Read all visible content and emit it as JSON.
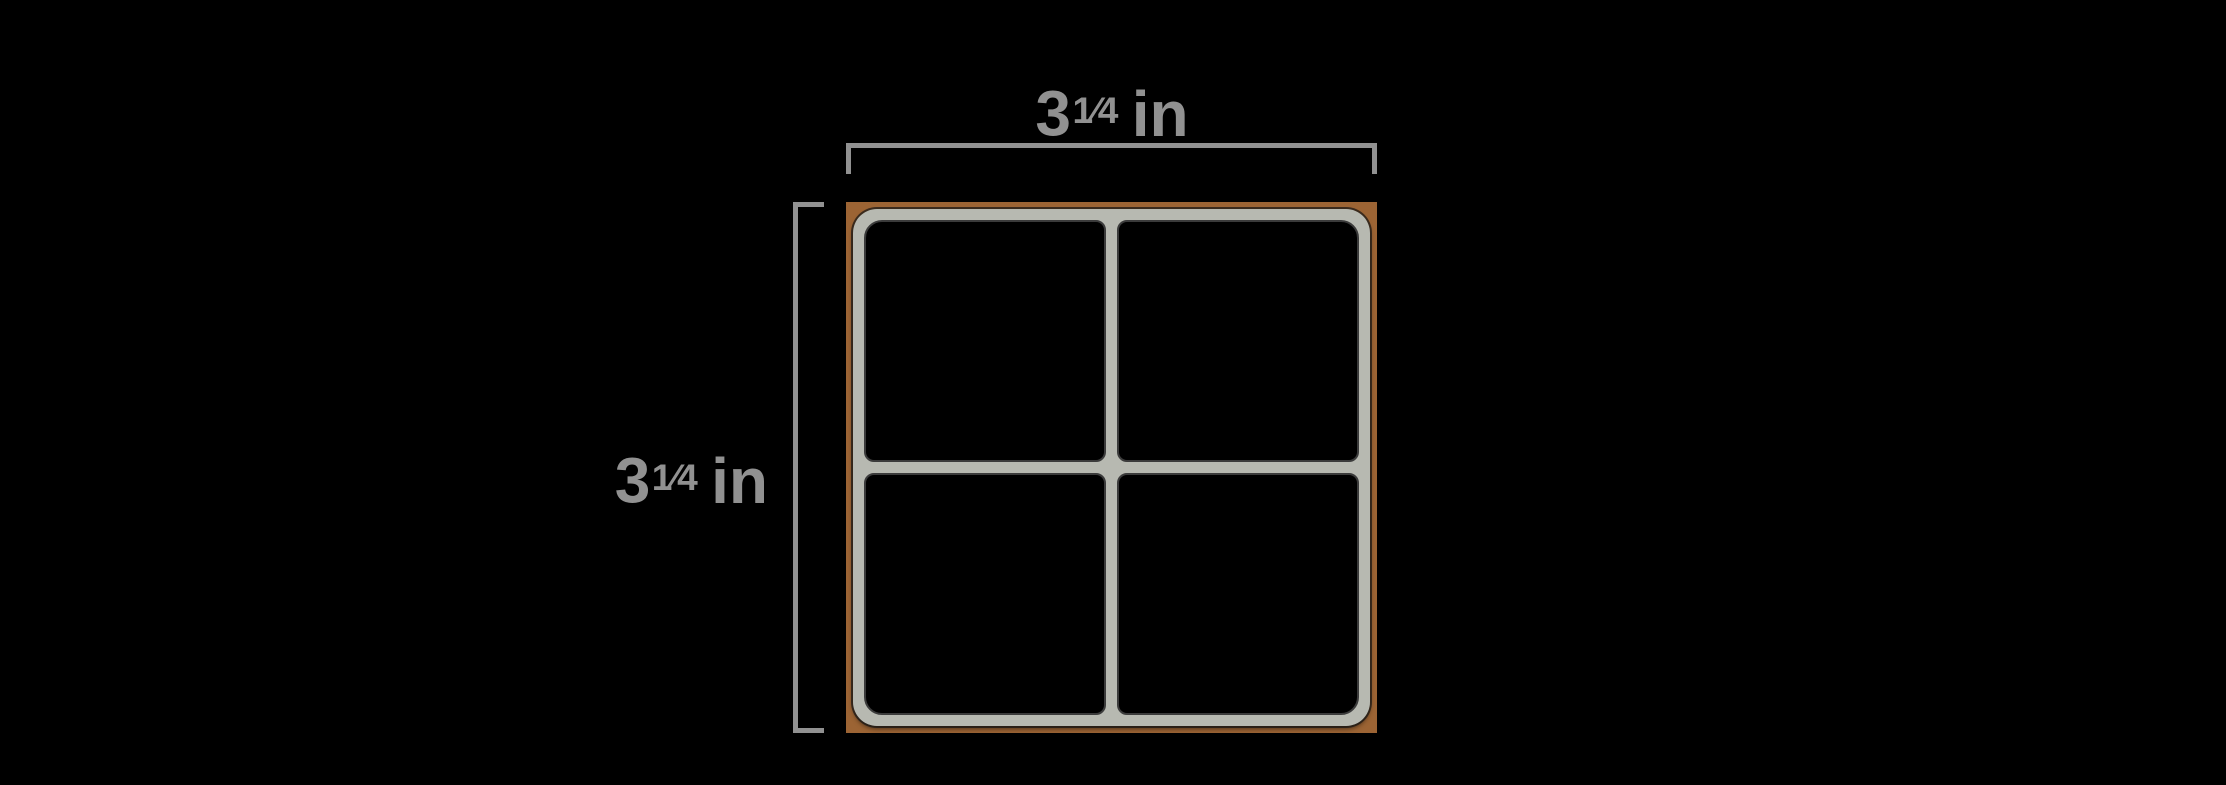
{
  "colors": {
    "background": "#000000",
    "dimension": "#919191",
    "sheet_backing": "#9c6434",
    "frame": "#b7b9b1",
    "pane": "#000000"
  },
  "dimensions": {
    "width": {
      "whole": "3",
      "fraction": "1⁄4",
      "unit": "in",
      "full_text": "3¼ in"
    },
    "height": {
      "whole": "3",
      "fraction": "1⁄4",
      "unit": "in",
      "full_text": "3¼ in"
    }
  },
  "sheet": {
    "rows": 2,
    "cols": 2
  }
}
